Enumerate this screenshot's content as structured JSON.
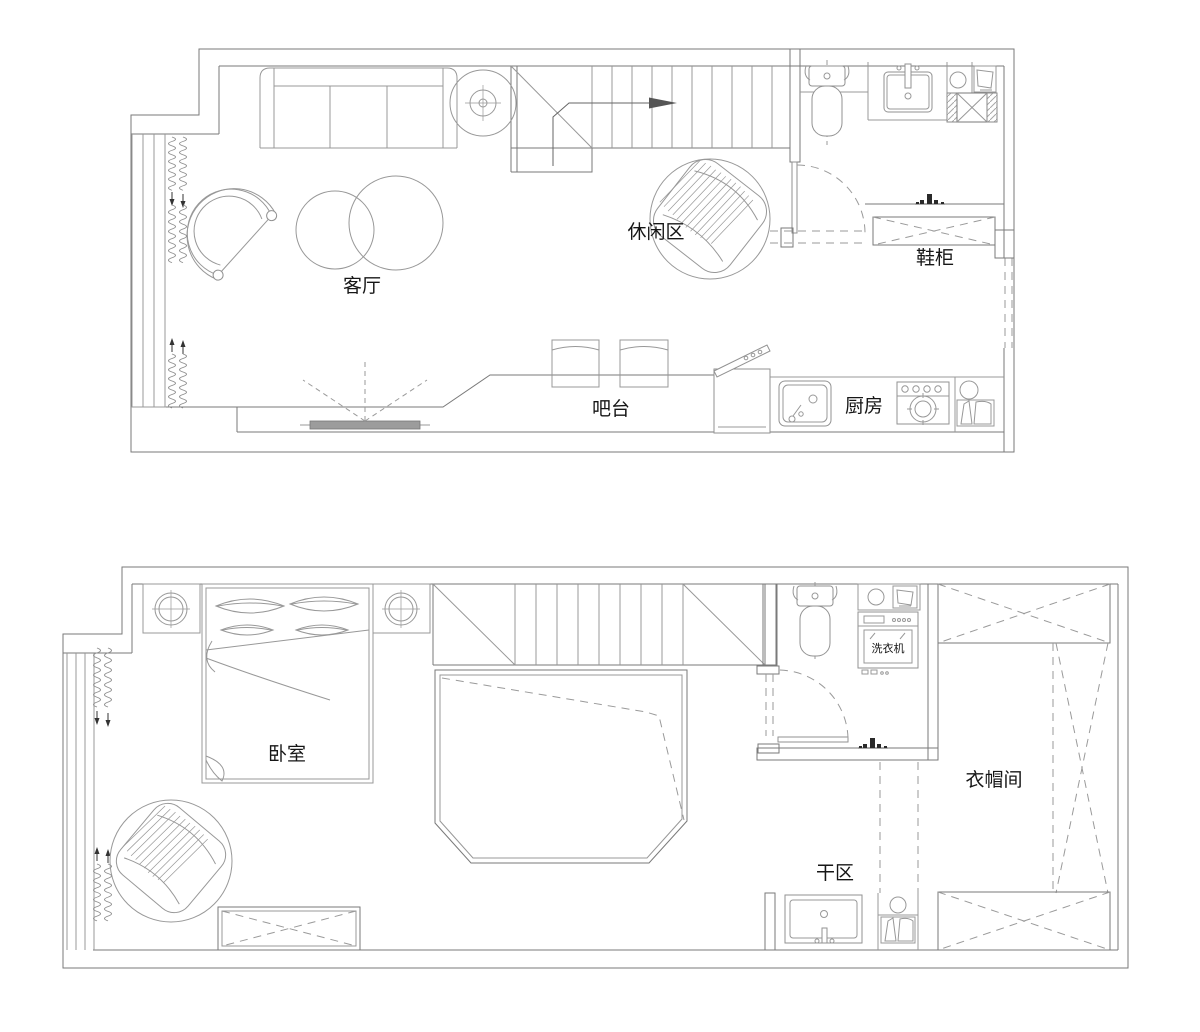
{
  "drawing": {
    "background_color": "#ffffff",
    "wall_line_color": "#7a7a7a",
    "furniture_line_color": "#989898",
    "text_color": "#161616",
    "upper_floor": {
      "labels": {
        "living_room": "客厅",
        "leisure_area": "休闲区",
        "shoe_cabinet": "鞋柜",
        "bar_counter": "吧台",
        "kitchen": "厨房"
      }
    },
    "lower_floor": {
      "labels": {
        "bedroom": "卧室",
        "washing_machine": "洗衣机",
        "cloakroom": "衣帽间",
        "dry_area": "干区"
      }
    }
  }
}
